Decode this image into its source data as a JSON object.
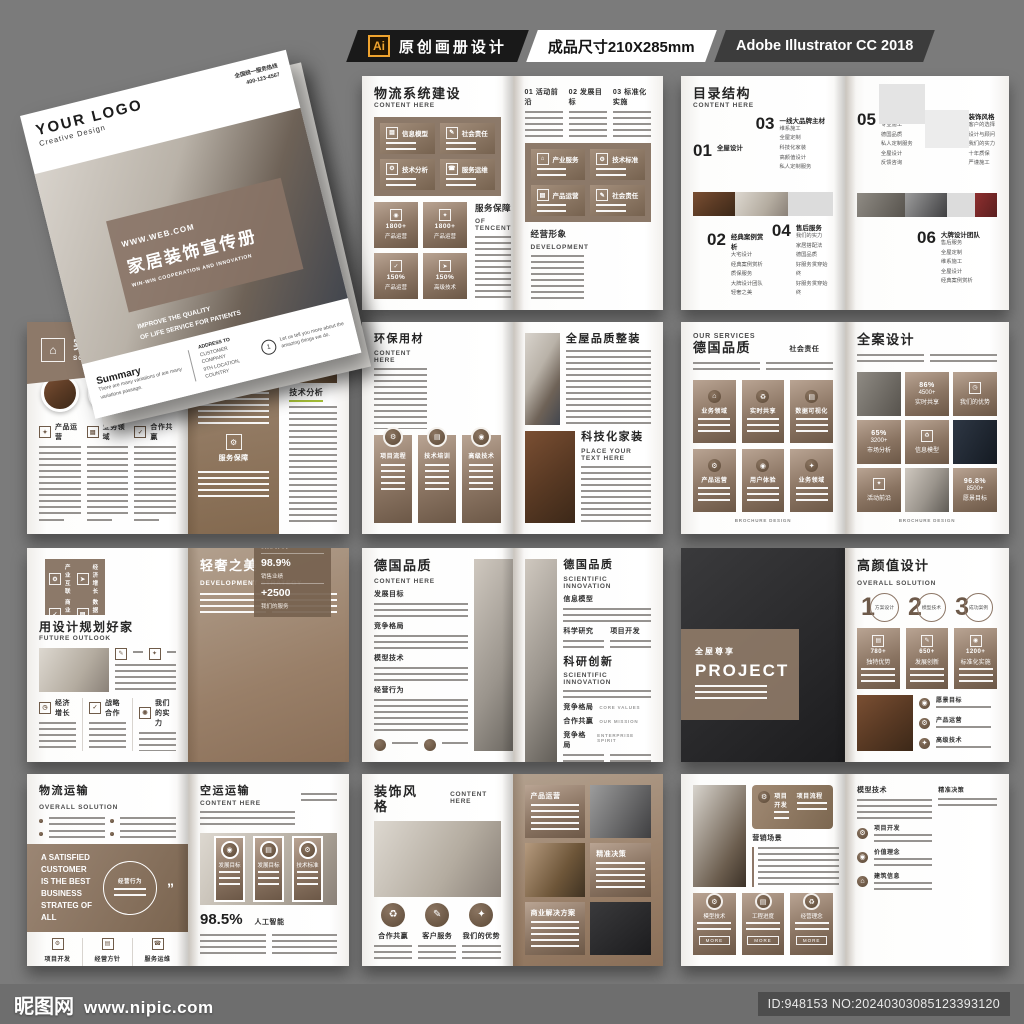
{
  "header": {
    "ai_badge": "Ai",
    "title": "原创画册设计",
    "size_label": "成品尺寸210X285mm",
    "software": "Adobe Illustrator CC 2018"
  },
  "watermark": {
    "brand": "昵图网",
    "url": "www.nipic.com",
    "id_label": "ID:948153 NO:20240303085123393120"
  },
  "cover": {
    "logo": "YOUR LOGO",
    "logo_sub": "Creative Design",
    "hotline": "全国统一服务热线",
    "phone": "400-123-4567",
    "website": "WWW.WEB.COM",
    "title": "家居装饰宣传册",
    "subtitle": "WIN-WIN COOPERATION AND INNOVATION",
    "tagline": [
      "IMPROVE THE QUALITY",
      "OF LIFE SERVICE FOR PATIENTS"
    ],
    "summary_title": "Summary",
    "summary_text": "There are many variations of are many variations passage.",
    "address_title": "ADDRESS TO",
    "address_lines": [
      "CUSTOMER COMPANY",
      "9TH LOCATION, COUNTRY"
    ],
    "note_num": "1",
    "note_text": "Let us tell you more about the amazing things we do."
  },
  "s1": {
    "title_cn": "物流系统建设",
    "title_en": "CONTENT HERE",
    "band_left": [
      "信息模型",
      "社会责任",
      "技术分析",
      "服务运维"
    ],
    "band_right": [
      "产业服务",
      "技术标准",
      "产品运营",
      "社会责任"
    ],
    "tiles": [
      {
        "n": "1800+",
        "t": "产品运营"
      },
      {
        "n": "1800+",
        "t": "产品运营"
      },
      {
        "n": "150%",
        "t": "产品运营"
      },
      {
        "n": "150%",
        "t": "高级技术"
      }
    ],
    "service_cn": "服务保障",
    "service_en": "OF TENCENT",
    "cols": [
      "01 活动前沿",
      "02 发展目标",
      "03 标准化实施"
    ],
    "brand_cn": "经营形象",
    "brand_en": "DEVELOPMENT"
  },
  "s2": {
    "title_cn": "目录结构",
    "title_en": "CONTENT HERE",
    "items": [
      {
        "num": "01",
        "title": "全屋设计",
        "subs": []
      },
      {
        "num": "02",
        "title": "经典案例赏析",
        "subs": [
          "大宅设计",
          "经典案例赏析",
          "质保服务",
          "大牌设计团队",
          "轻奢之美"
        ]
      },
      {
        "num": "03",
        "title": "一线大品牌主材",
        "subs": [
          "维系施工",
          "全屋定制",
          "科技化家装",
          "高颜值设计",
          "私人定制服务"
        ]
      },
      {
        "num": "04",
        "title": "售后服务",
        "subs": [
          "我们的实力",
          "家居搭配法",
          "德国品质",
          "好服务贯穿始终",
          "好服务贯穿始终"
        ]
      },
      {
        "num": "05",
        "title": "持久耐用",
        "subs": [
          "专业施工",
          "德国品质",
          "私人定制服务",
          "全屋设计",
          "反馈咨询"
        ]
      },
      {
        "num": "06",
        "title": "大牌设计团队",
        "subs": [
          "售后服务",
          "全屋定制",
          "维系施工",
          "全屋设计",
          "经典案例赏析"
        ]
      },
      {
        "num": "07",
        "title": "装饰风格",
        "subs": [
          "客户的选择",
          "设计与顾问",
          "我们的实力",
          "十年质保",
          "严谨施工"
        ]
      }
    ]
  },
  "s3": {
    "title_cn": "实景样板间",
    "title_en": "SCOPE OF BUSINESS",
    "cols": [
      "产品运营",
      "业务领域",
      "合作共赢"
    ],
    "right_sections": [
      "企业荣誉",
      "服务保障"
    ],
    "analysis": "技术分析"
  },
  "s4": {
    "title_cn": "环保用材",
    "title_en": "CONTENT HERE",
    "cards": [
      "项目流程",
      "技术培训",
      "高级技术"
    ],
    "right_title": "全屋品质整装",
    "tech_cn": "科技化家装",
    "tech_en": "PLACE YOUR TEXT HERE"
  },
  "s5": {
    "eyebrow": "OUR SERVICES",
    "title_cn": "德国品质",
    "side_label": "社会责任",
    "cards": [
      "业务领域",
      "实时共享",
      "数据可视化",
      "产品运营",
      "用户体验",
      "业务领域"
    ],
    "footer": "BROCHURE DESIGN",
    "right_title": "全案设计",
    "stat1": {
      "p": "86%",
      "n": "4500+",
      "t": "实时共享"
    },
    "adv": "我们的优势",
    "stat2": {
      "p": "65%",
      "n": "3200+",
      "t": "市场分析"
    },
    "model": "信息模型",
    "act": "活动前沿",
    "stat3": {
      "p": "96.8%",
      "n": "8500+",
      "t": "愿景目标"
    }
  },
  "s6": {
    "banner": [
      "产业互联",
      "经济增长",
      "商业合作",
      "数据管理"
    ],
    "title_cn": "用设计规划好家",
    "title_en": "FUTURE OUTLOOK",
    "cols": [
      "经济增长",
      "战略合作",
      "我们的实力"
    ],
    "right_cn": "轻奢之美",
    "right_en": "DEVELOPMENT STRATEGY",
    "stats": [
      {
        "n": "125.000",
        "t": "我们的实力"
      },
      {
        "n": "98.9%",
        "t": "销售业绩"
      },
      {
        "n": "+2500",
        "t": "我们的服务"
      }
    ]
  },
  "s7": {
    "title_cn": "德国品质",
    "title_en": "CONTENT HERE",
    "sections": [
      "发展目标",
      "竞争格局",
      "模型技术",
      "经营行为"
    ],
    "right_cn": "德国品质",
    "right_en": "SCIENTIFIC INNOVATION",
    "sub1": "信息模型",
    "cols": [
      "科学研究",
      "项目开发"
    ],
    "innov_cn": "科研创新",
    "innov_en": "SCIENTIFIC INNOVATION",
    "rows": [
      {
        "cn": "竞争格局",
        "en": "CORE VALUES"
      },
      {
        "cn": "合作共赢",
        "en": "OUR MISSION"
      },
      {
        "cn": "竞争格局",
        "en": "ENTERPRISE SPIRIT"
      }
    ]
  },
  "s8": {
    "left_cn": "全屋尊享",
    "left_en": "PROJECT",
    "title_cn": "高颜值设计",
    "title_en": "OVERALL SOLUTION",
    "steps": [
      {
        "n": "1",
        "t": "方案设计"
      },
      {
        "n": "2",
        "t": "模型技术"
      },
      {
        "n": "3",
        "t": "成功案例"
      }
    ],
    "cards": [
      {
        "n": "780+",
        "t": "独特优势"
      },
      {
        "n": "650+",
        "t": "发展创新"
      },
      {
        "n": "1200+",
        "t": "标准化实施"
      }
    ],
    "bullets": [
      "愿景目标",
      "产品运营",
      "高级技术"
    ]
  },
  "s9": {
    "title_cn": "物流运输",
    "title_en": "OVERALL SOLUTION",
    "quote": "A SATISFIED CUSTOMER IS THE BEST BUSINESS STRATEG OF ALL",
    "circle_label": "经营行为",
    "cols": [
      "项目开发",
      "经营方针",
      "服务运维"
    ],
    "right_cn": "空运运输",
    "right_en": "CONTENT HERE",
    "cards": [
      "发展目标",
      "发展目标",
      "技术标准"
    ],
    "stat_n": "98.5%",
    "stat_t": "人工智能"
  },
  "s10": {
    "title_cn": "装饰风格",
    "title_en": "CONTENT HERE",
    "circles": [
      "合作共赢",
      "客户服务",
      "我们的优势"
    ],
    "cards": [
      "产品运营",
      "精准决策",
      "商业解决方案"
    ]
  },
  "s11": {
    "band": [
      "项目开发",
      "项目流程"
    ],
    "sec1": "营销场景",
    "cards": [
      "模型技术",
      "工程进度",
      "经营理念"
    ],
    "more": "MORE",
    "right_top": "精准决策",
    "right_sec": "模型技术",
    "bullets": [
      "项目开发",
      "价值理念",
      "建筑信息"
    ]
  }
}
